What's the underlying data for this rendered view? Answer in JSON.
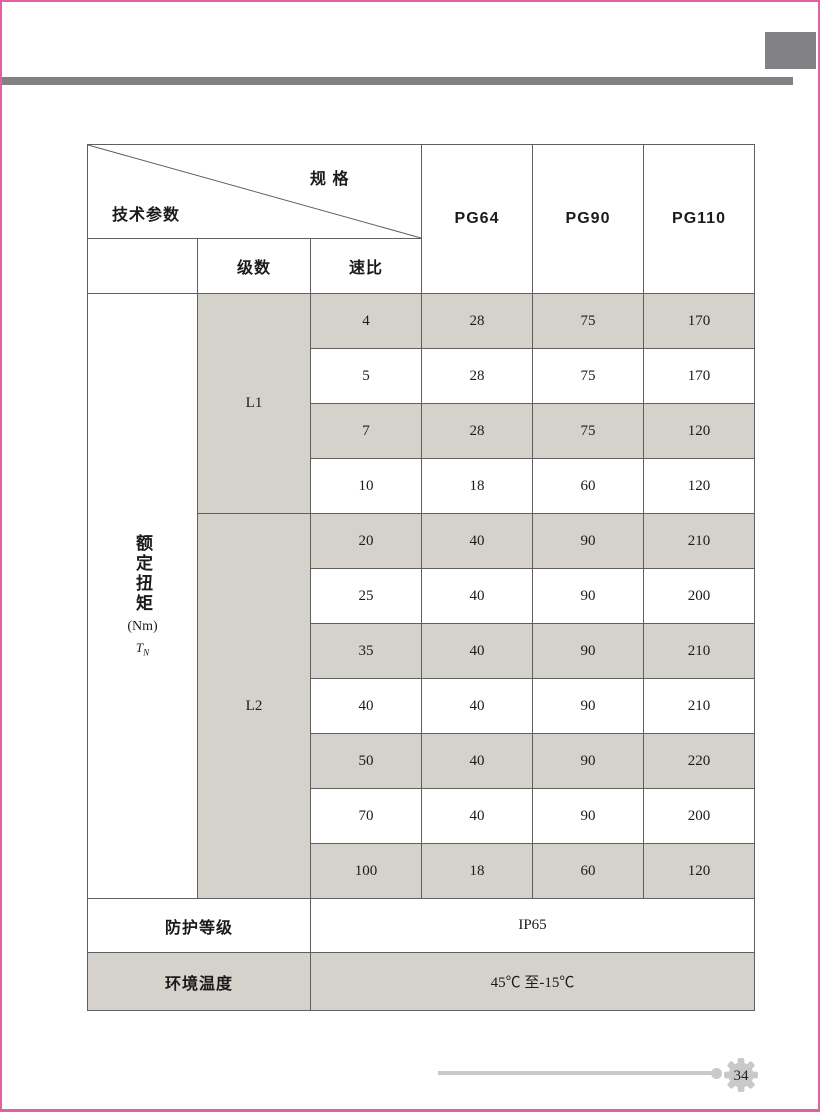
{
  "page": {
    "number": "34",
    "colors": {
      "accent_pink": "#e2609d",
      "bar_gray": "#828186",
      "row_shade": "#d5d2cc",
      "footer_rule_gray": "#c9c9c9"
    }
  },
  "table": {
    "corner": {
      "spec_label": "规 格",
      "param_label": "技术参数"
    },
    "col_headers": [
      "PG64",
      "PG90",
      "PG110"
    ],
    "subheaders": {
      "stages": "级数",
      "ratio": "速比"
    },
    "torque_label": {
      "text": "额定扭矩",
      "unit": "(Nm)",
      "sym": "T",
      "sym_sub": "N"
    },
    "groups": [
      {
        "stage": "L1",
        "rows": [
          {
            "ratio": "4",
            "v": [
              "28",
              "75",
              "170"
            ]
          },
          {
            "ratio": "5",
            "v": [
              "28",
              "75",
              "170"
            ]
          },
          {
            "ratio": "7",
            "v": [
              "28",
              "75",
              "120"
            ]
          },
          {
            "ratio": "10",
            "v": [
              "18",
              "60",
              "120"
            ]
          }
        ]
      },
      {
        "stage": "L2",
        "rows": [
          {
            "ratio": "20",
            "v": [
              "40",
              "90",
              "210"
            ]
          },
          {
            "ratio": "25",
            "v": [
              "40",
              "90",
              "200"
            ]
          },
          {
            "ratio": "35",
            "v": [
              "40",
              "90",
              "210"
            ]
          },
          {
            "ratio": "40",
            "v": [
              "40",
              "90",
              "210"
            ]
          },
          {
            "ratio": "50",
            "v": [
              "40",
              "90",
              "220"
            ]
          },
          {
            "ratio": "70",
            "v": [
              "40",
              "90",
              "200"
            ]
          },
          {
            "ratio": "100",
            "v": [
              "18",
              "60",
              "120"
            ]
          }
        ]
      }
    ],
    "footer_rows": [
      {
        "label": "防护等级",
        "value": "IP65"
      },
      {
        "label": "环境温度",
        "value": "45℃ 至-15℃"
      }
    ]
  }
}
